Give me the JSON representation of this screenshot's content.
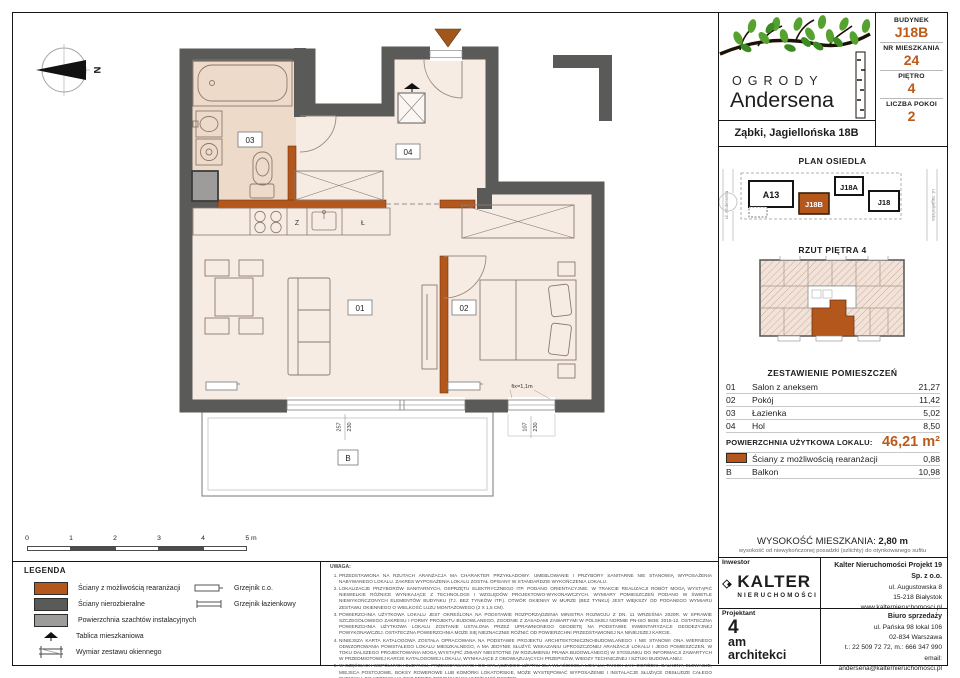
{
  "header": {
    "brand_top": "OGRODY",
    "brand_name": "Andersena",
    "address": "Ząbki, Jagiellońska 18B"
  },
  "info": {
    "rows": [
      {
        "label": "BUDYNEK",
        "value": "J18B"
      },
      {
        "label": "NR MIESZKANIA",
        "value": "24"
      },
      {
        "label": "PIĘTRO",
        "value": "4"
      },
      {
        "label": "LICZBA POKOI",
        "value": "2"
      }
    ]
  },
  "site_plan": {
    "title": "PLAN OSIEDLA",
    "buildings": [
      {
        "name": "A13"
      },
      {
        "name": "J18B",
        "highlighted": true
      },
      {
        "name": "J18A"
      },
      {
        "name": "J18"
      }
    ],
    "street_left": "ul. Andersena",
    "street_right": "ul. Jagiellońska"
  },
  "floor_thumb": {
    "title": "RZUT PIĘTRA 4"
  },
  "rooms_table": {
    "title": "ZESTAWIENIE POMIESZCZEŃ",
    "rows": [
      {
        "no": "01",
        "name": "Salon z aneksem",
        "area": "21,27"
      },
      {
        "no": "02",
        "name": "Pokój",
        "area": "11,42"
      },
      {
        "no": "03",
        "name": "Łazienka",
        "area": "5,02"
      },
      {
        "no": "04",
        "name": "Hol",
        "area": "8,50"
      }
    ],
    "total_label": "POWIERZCHNIA UŻYTKOWA LOKALU:",
    "total_value": "46,21 m²",
    "walls_row": {
      "name": "Ściany z możliwością rearanżacji",
      "area": "0,88"
    },
    "balcony_row": {
      "no": "B",
      "name": "Balkon",
      "area": "10,98"
    }
  },
  "height": {
    "label": "WYSOKOŚĆ MIESZKANIA:",
    "value": "2,80 m",
    "sub": "wysokość od niewykończonej posadzki (szlichty) do otynkowanego sufitu"
  },
  "footer": {
    "investor_label": "Inwestor",
    "designer_label": "Projektant",
    "kalter": {
      "logo_text": "KALTER",
      "logo_sub": "NIERUCHOMOŚCI",
      "company": "Kalter Nieruchomości Projekt 19 Sp. z o.o.",
      "line1": "ul. Augustowska 8",
      "line2": "15-218 Białystok",
      "line3": "www.kalternieruchomosci.pl"
    },
    "architect": {
      "l1": "4",
      "l2": "am",
      "l3": "architekci"
    },
    "sales": {
      "title": "Biuro sprzedaży",
      "line1": "ul. Pańska 98 lokal 106",
      "line2": "02-834 Warszawa",
      "line3": "t.: 22 509 72 72, m.: 666 347 990",
      "line4": "email: andersena@kalternieruchomosci.pl"
    }
  },
  "plan": {
    "labels": {
      "r01": "01",
      "r02": "02",
      "r03": "03",
      "r04": "04",
      "balcony": "B"
    },
    "kitchen": {
      "letter1": "Z",
      "letter2": "Ł"
    },
    "dims": {
      "w1a": "257",
      "w1b": "230",
      "w2a": "107",
      "w2b": "230",
      "fix": "fix=1,1m"
    },
    "compass_north": "N"
  },
  "scalebar": {
    "labels": [
      "0",
      "1",
      "2",
      "3",
      "4",
      "5 m"
    ]
  },
  "legend": {
    "title": "LEGENDA",
    "items": [
      {
        "label": "Ściany z możliwością rearanżacji"
      },
      {
        "label": "Ściany nierozbieralne"
      },
      {
        "label": "Powierzchnia szachtów instalacyjnych"
      },
      {
        "label": "Tablica mieszkaniowa"
      },
      {
        "label": "Wymiar zestawu okiennego"
      }
    ],
    "right_items": [
      {
        "label": "Grzejnik c.o."
      },
      {
        "label": "Grzejnik łazienkowy"
      }
    ]
  },
  "uwaga": {
    "title": "UWAGA:",
    "notes": [
      "PRZEDSTAWIONA NA RZUTACH ARANŻACJA MA CHARAKTER PRZYKŁADOWY. UMEBLOWANIE I PRZYBORY SANITARNE NIE STANOWIĄ WYPOSAŻENIA NABYWANEGO LOKALU. ZAKRES WYPOSAŻENIA LOKALU ZOSTAŁ OPISANY W STANDARDZIE WYKOŃCZENIA LOKALU.",
      "LOKALIZACJE PRZYBORÓW SANITARNYCH, OSPRZĘTU ELEKTRYCZNEGO ITP. PODANO ORIENTACYJNIE. W TRAKCIE REALIZACJI ROBÓT MOGĄ WYSTĄPIĆ NIEWIELKIE RÓŻNICE WYNIKAJĄCE Z TECHNOLOGII I WZGLĘDÓW PROJEKTOWO-WYKONAWCZYCH. WYMIARY POMIESZCZEŃ PODANO W ŚWIETLE NIEWYKOŃCZONYCH ELEMENTÓW BUDYNKU (TJ. BEZ TYNKÓW ITP.). OTWÓR OKIENNY W MURZE (BEZ TYNKU) JEST WIĘKSZY OD PODANEGO WYMIARU ZESTAWU OKIENNEGO O WIELKOŚĆ LUZU MONTAŻOWEGO (2 X 1,5 CM).",
      "POWIERZCHNIA UŻYTKOWA LOKALU JEST OKREŚLONA NA PODSTAWIE ROZPORZĄDZENIA MINISTRA ROZWOJU Z DN. 11 WRZEŚNIA 2020R. W SPRAWIE SZCZEGÓŁOWEGO ZAKRESU I FORMY PROJEKTU BUDOWLANEGO, ZGODNIE Z ZASADAMI ZAWARTYMI W POLSKIEJ NORMIE PN-ISO 9836: 2015-12. OSTATECZNA POWIERZCHNIA UŻYTKOWA LOKALU ZOSTANIE USTALONA PRZEZ UPRAWNIONEGO GEODETĘ NA PODSTAWIE INWENTARYZACJI GEODEZYJNEJ POWYKONAWCZEJ. OSTATECZNA POWIERZCHNIA MOŻE SIĘ NIEZNACZNIE RÓŻNIĆ OD POWIERZCHNI PRZEDSTAWIONEJ NA NINIEJSZEJ KARCIE.",
      "NINIEJSZA KARTA KATALOGOWA ZOSTAŁA OPRACOWANA NA PODSTAWIE PROJEKTU ARCHITEKTONICZNO-BUDOWLANEGO I NIE STANOWI ONA WIERNEGO ODWZOROWANIA POWSTAŁEGO LOKALU MIESZKALNEGO, A MA JEDYNIE SŁUŻYĆ WSKAZANIU UPROSZCZONEJ ARANŻACJI LOKALU I JEGO POMIESZCZEŃ. W TOKU DALSZEGO PROJEKTOWANIA MOGĄ WYSTĄPIĆ ZMIANY NIEISTOTNE (W ROZUMIENIU PRAWA BUDOWLANEGO) W STOSUNKU DO INFORMACJI ZAWARTYCH W PRZEDMIOTOWEJ KARCIE KATALOGOWEJ LOKALU, WYNIKAJĄCE Z OBOWIĄZUJĄCYCH PRZEPISÓW, WIEDZY TECHNICZNEJ I SZTUKI BUDOWLANEJ.",
      "W CZĘŚCIACH WSPÓLNYCH BUDYNKU, PRZEWIDYWANYCH DO WYŁĄCZNEGO UŻYTKU DLA WŁAŚCICIELA LOKALU, TAKICH JAK: OGRÓDKI, BALKONY, ELEWACJE, MIEJSCA POSTOJOWE, BOKSY ROWEROWE LUB KOMÓRKI LOKATORSKIE, MOŻE WYSTĘPOWAĆ WYPOSAŻENIE I INSTALACJE SŁUŻĄCE OBSŁUDZE CAŁEGO BUDYNKU, DO KTÓRYCH KLIENT BĘDZIE ZOBOWIĄZANY UMOŻLIWIĆ DOSTĘP.",
      "NINIEJSZA KARTA NIE PRZEDSTAWIA KOMPLETNEGO PROJEKTU WIELOBRANŻOWEGO. RYSUNEK NIE JEST PRZEZNACZONY DO CELÓW WYKONAWCZYCH. SZCZEGÓŁOWE INFORMACJE PROJEKTOWE ZNAJDUJĄ SIĘ W DOKUMENTACJI TECHNICZNO-WYKONAWCZEJ DOSTĘPNEJ DO WGLĄDU DLA KLIENTÓW W BIURZE INWESTORA.",
      "PROJEKT CHRONIONY PRAWEM AUTORSKIM."
    ]
  },
  "colors": {
    "accent_orange": "#bc5a1b",
    "wall_orange": "#b4571c",
    "wall_gray": "#5a5a58",
    "shaft_gray": "#9d9c9b",
    "floor": "#f7ece4",
    "bath_floor": "#eedac9"
  }
}
